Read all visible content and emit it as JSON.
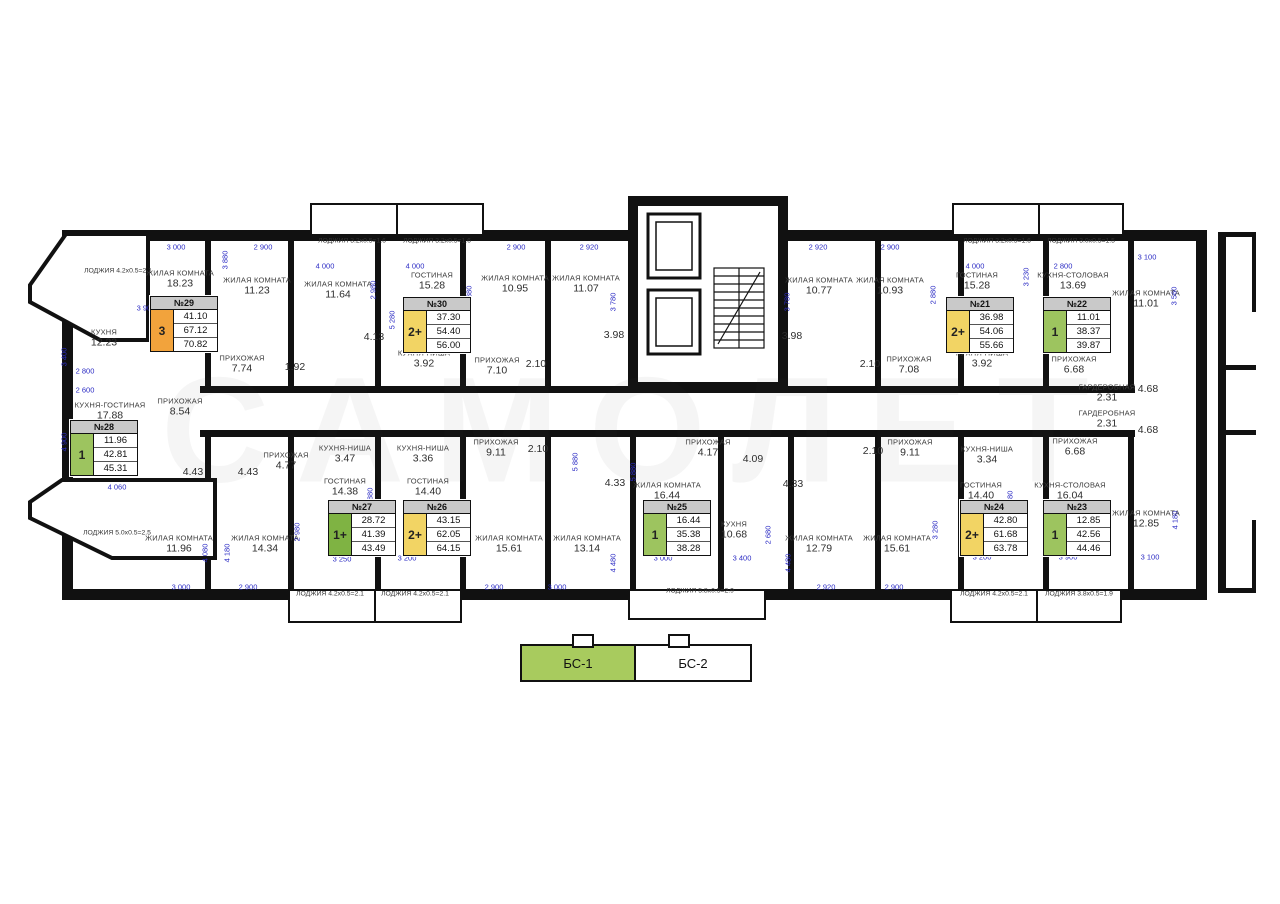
{
  "watermark": "САМОЛЕТ",
  "legend": {
    "bs1": "БС-1",
    "bs2": "БС-2"
  },
  "colors": {
    "wall": "#111111",
    "dim_blue": "#2b2bc4",
    "card_header_gray": "#c9c9c9",
    "badge_orange": "#f2a33c",
    "badge_yellow": "#f2d464",
    "badge_green": "#9dc45f",
    "badge_dark_green": "#7fb343",
    "legend_green": "#a8cb5e"
  },
  "cards": [
    {
      "num": "№29",
      "badge": "3",
      "bc": "badge_orange",
      "v1": "41.10",
      "v2": "67.12",
      "v3": "70.82",
      "x": 150,
      "y": 296
    },
    {
      "num": "№30",
      "badge": "2+",
      "bc": "badge_yellow",
      "v1": "37.30",
      "v2": "54.40",
      "v3": "56.00",
      "x": 403,
      "y": 297
    },
    {
      "num": "№21",
      "badge": "2+",
      "bc": "badge_yellow",
      "v1": "36.98",
      "v2": "54.06",
      "v3": "55.66",
      "x": 946,
      "y": 297
    },
    {
      "num": "№22",
      "badge": "1",
      "bc": "badge_green",
      "v1": "11.01",
      "v2": "38.37",
      "v3": "39.87",
      "x": 1043,
      "y": 297
    },
    {
      "num": "№28",
      "badge": "1",
      "bc": "badge_green",
      "v1": "11.96",
      "v2": "42.81",
      "v3": "45.31",
      "x": 70,
      "y": 420
    },
    {
      "num": "№27",
      "badge": "1+",
      "bc": "badge_dark_green",
      "v1": "28.72",
      "v2": "41.39",
      "v3": "43.49",
      "x": 328,
      "y": 500
    },
    {
      "num": "№26",
      "badge": "2+",
      "bc": "badge_yellow",
      "v1": "43.15",
      "v2": "62.05",
      "v3": "64.15",
      "x": 403,
      "y": 500
    },
    {
      "num": "№25",
      "badge": "1",
      "bc": "badge_green",
      "v1": "16.44",
      "v2": "35.38",
      "v3": "38.28",
      "x": 643,
      "y": 500
    },
    {
      "num": "№24",
      "badge": "2+",
      "bc": "badge_yellow",
      "v1": "42.80",
      "v2": "61.68",
      "v3": "63.78",
      "x": 960,
      "y": 500
    },
    {
      "num": "№23",
      "badge": "1",
      "bc": "badge_green",
      "v1": "12.85",
      "v2": "42.56",
      "v3": "44.46",
      "x": 1043,
      "y": 500
    }
  ],
  "rooms": [
    {
      "n": "ЛОДЖИЯ 4.2x0.5=2.1",
      "a": "",
      "x": 118,
      "y": 271,
      "s": 1
    },
    {
      "n": "ЖИЛАЯ КОМНАТА",
      "a": "18.23",
      "x": 180,
      "y": 279
    },
    {
      "n": "КУХНЯ",
      "a": "12.23",
      "x": 104,
      "y": 338
    },
    {
      "n": "ЖИЛАЯ КОМНАТА",
      "a": "11.23",
      "x": 257,
      "y": 286
    },
    {
      "n": "ЖИЛАЯ КОМНАТА",
      "a": "11.64",
      "x": 338,
      "y": 290
    },
    {
      "n": "ГОСТИНАЯ",
      "a": "15.28",
      "x": 432,
      "y": 281
    },
    {
      "n": "ЖИЛАЯ КОМНАТА",
      "a": "10.95",
      "x": 515,
      "y": 284
    },
    {
      "n": "ЖИЛАЯ КОМНАТА",
      "a": "11.07",
      "x": 586,
      "y": 284
    },
    {
      "n": "ЖИЛАЯ КОМНАТА",
      "a": "10.77",
      "x": 819,
      "y": 286
    },
    {
      "n": "ЖИЛАЯ КОМНАТА",
      "a": "10.93",
      "x": 890,
      "y": 286
    },
    {
      "n": "ГОСТИНАЯ",
      "a": "15.28",
      "x": 977,
      "y": 281
    },
    {
      "n": "КУХНЯ-СТОЛОВАЯ",
      "a": "13.69",
      "x": 1073,
      "y": 281
    },
    {
      "n": "ЖИЛАЯ КОМНАТА",
      "a": "11.01",
      "x": 1146,
      "y": 299
    },
    {
      "n": "ПРИХОЖАЯ",
      "a": "7.74",
      "x": 242,
      "y": 364
    },
    {
      "n": "",
      "a": "1.92",
      "x": 295,
      "y": 367
    },
    {
      "n": "",
      "a": "4.13",
      "x": 374,
      "y": 337
    },
    {
      "n": "КУХНЯ-НИША",
      "a": "3.92",
      "x": 424,
      "y": 359
    },
    {
      "n": "ПРИХОЖАЯ",
      "a": "7.10",
      "x": 497,
      "y": 366
    },
    {
      "n": "",
      "a": "2.10",
      "x": 536,
      "y": 364
    },
    {
      "n": "",
      "a": "3.98",
      "x": 614,
      "y": 335
    },
    {
      "n": "",
      "a": "3.98",
      "x": 792,
      "y": 336
    },
    {
      "n": "",
      "a": "2.10",
      "x": 870,
      "y": 364
    },
    {
      "n": "ПРИХОЖАЯ",
      "a": "7.08",
      "x": 909,
      "y": 365
    },
    {
      "n": "КУХНЯ-НИША",
      "a": "3.92",
      "x": 982,
      "y": 359
    },
    {
      "n": "ПРИХОЖАЯ",
      "a": "6.68",
      "x": 1074,
      "y": 365
    },
    {
      "n": "ГАРДЕРОБНАЯ",
      "a": "2.31",
      "x": 1107,
      "y": 393
    },
    {
      "n": "ГАРДЕРОБНАЯ",
      "a": "2.31",
      "x": 1107,
      "y": 419
    },
    {
      "n": "",
      "a": "4.68",
      "x": 1148,
      "y": 389
    },
    {
      "n": "",
      "a": "4.68",
      "x": 1148,
      "y": 430
    },
    {
      "n": "КУХНЯ-ГОСТИНАЯ",
      "a": "17.88",
      "x": 110,
      "y": 411
    },
    {
      "n": "ПРИХОЖАЯ",
      "a": "8.54",
      "x": 180,
      "y": 407
    },
    {
      "n": "",
      "a": "4.43",
      "x": 193,
      "y": 472
    },
    {
      "n": "",
      "a": "4.43",
      "x": 248,
      "y": 472
    },
    {
      "n": "ПРИХОЖАЯ",
      "a": "4.77",
      "x": 286,
      "y": 461
    },
    {
      "n": "КУХНЯ-НИША",
      "a": "3.47",
      "x": 345,
      "y": 454
    },
    {
      "n": "ГОСТИНАЯ",
      "a": "14.38",
      "x": 345,
      "y": 487
    },
    {
      "n": "ЛОДЖИЯ 5.0x0.5=2.5",
      "a": "",
      "x": 117,
      "y": 533,
      "s": 1
    },
    {
      "n": "ЖИЛАЯ КОМНАТА",
      "a": "11.96",
      "x": 179,
      "y": 544
    },
    {
      "n": "ЖИЛАЯ КОМНАТА",
      "a": "14.34",
      "x": 265,
      "y": 544
    },
    {
      "n": "КУХНЯ-НИША",
      "a": "3.36",
      "x": 423,
      "y": 454
    },
    {
      "n": "ГОСТИНАЯ",
      "a": "14.40",
      "x": 428,
      "y": 487
    },
    {
      "n": "ПРИХОЖАЯ",
      "a": "9.11",
      "x": 496,
      "y": 448
    },
    {
      "n": "",
      "a": "2.10",
      "x": 538,
      "y": 449
    },
    {
      "n": "ЖИЛАЯ КОМНАТА",
      "a": "15.61",
      "x": 509,
      "y": 544
    },
    {
      "n": "ЖИЛАЯ КОМНАТА",
      "a": "13.14",
      "x": 587,
      "y": 544
    },
    {
      "n": "",
      "a": "4.33",
      "x": 615,
      "y": 483
    },
    {
      "n": "ПРИХОЖАЯ",
      "a": "4.17",
      "x": 708,
      "y": 448
    },
    {
      "n": "",
      "a": "4.09",
      "x": 753,
      "y": 459
    },
    {
      "n": "ЖИЛАЯ КОМНАТА",
      "a": "16.44",
      "x": 667,
      "y": 491
    },
    {
      "n": "КУХНЯ",
      "a": "10.68",
      "x": 734,
      "y": 530
    },
    {
      "n": "",
      "a": "4.33",
      "x": 793,
      "y": 484
    },
    {
      "n": "ЖИЛАЯ КОМНАТА",
      "a": "12.79",
      "x": 819,
      "y": 544
    },
    {
      "n": "ЖИЛАЯ КОМНАТА",
      "a": "15.61",
      "x": 897,
      "y": 544
    },
    {
      "n": "",
      "a": "2.10",
      "x": 873,
      "y": 451
    },
    {
      "n": "ПРИХОЖАЯ",
      "a": "9.11",
      "x": 910,
      "y": 448
    },
    {
      "n": "КУХНЯ-НИША",
      "a": "3.34",
      "x": 987,
      "y": 455
    },
    {
      "n": "ГОСТИНАЯ",
      "a": "14.40",
      "x": 981,
      "y": 491
    },
    {
      "n": "КУХНЯ-СТОЛОВАЯ",
      "a": "16.04",
      "x": 1070,
      "y": 491
    },
    {
      "n": "ЖИЛАЯ КОМНАТА",
      "a": "12.85",
      "x": 1146,
      "y": 519
    },
    {
      "n": "ПРИХОЖАЯ",
      "a": "6.68",
      "x": 1075,
      "y": 447
    },
    {
      "n": "ЛОДЖИЯ 3.2x0.5=1.6",
      "a": "",
      "x": 352,
      "y": 241,
      "s": 1
    },
    {
      "n": "ЛОДЖИЯ 3.2x0.5=1.6",
      "a": "",
      "x": 437,
      "y": 241,
      "s": 1
    },
    {
      "n": "ЛОДЖИЯ 3.2x0.5=1.6",
      "a": "",
      "x": 997,
      "y": 241,
      "s": 1
    },
    {
      "n": "ЛОДЖИЯ 3.0x0.5=1.5",
      "a": "",
      "x": 1081,
      "y": 241,
      "s": 1
    },
    {
      "n": "ЛОДЖИЯ 4.2x0.5=2.1",
      "a": "",
      "x": 330,
      "y": 594,
      "s": 1
    },
    {
      "n": "ЛОДЖИЯ 4.2x0.5=2.1",
      "a": "",
      "x": 415,
      "y": 594,
      "s": 1
    },
    {
      "n": "ЛОДЖИЯ 5.8x0.5=2.9",
      "a": "",
      "x": 700,
      "y": 591,
      "s": 1
    },
    {
      "n": "ЛОДЖИЯ 4.2x0.5=2.1",
      "a": "",
      "x": 994,
      "y": 594,
      "s": 1
    },
    {
      "n": "ЛОДЖИЯ 3.8x0.5=1.9",
      "a": "",
      "x": 1079,
      "y": 594,
      "s": 1
    }
  ],
  "dims": [
    {
      "t": "3 000",
      "x": 176,
      "y": 247
    },
    {
      "t": "2 900",
      "x": 263,
      "y": 247
    },
    {
      "t": "2 900",
      "x": 516,
      "y": 247
    },
    {
      "t": "2 920",
      "x": 589,
      "y": 247
    },
    {
      "t": "2 920",
      "x": 818,
      "y": 247
    },
    {
      "t": "2 900",
      "x": 890,
      "y": 247
    },
    {
      "t": "3 100",
      "x": 1147,
      "y": 257
    },
    {
      "t": "4 000",
      "x": 325,
      "y": 266
    },
    {
      "t": "4 000",
      "x": 415,
      "y": 266
    },
    {
      "t": "4 000",
      "x": 975,
      "y": 266
    },
    {
      "t": "2 800",
      "x": 1063,
      "y": 266
    },
    {
      "t": "3 900",
      "x": 146,
      "y": 308
    },
    {
      "t": "2 800",
      "x": 85,
      "y": 371
    },
    {
      "t": "2 600",
      "x": 85,
      "y": 390
    },
    {
      "t": "4 060",
      "x": 117,
      "y": 487
    },
    {
      "t": "3 250",
      "x": 342,
      "y": 559
    },
    {
      "t": "3 200",
      "x": 407,
      "y": 558
    },
    {
      "t": "3 000",
      "x": 663,
      "y": 558
    },
    {
      "t": "3 400",
      "x": 742,
      "y": 558
    },
    {
      "t": "3 200",
      "x": 982,
      "y": 557
    },
    {
      "t": "3 900",
      "x": 1068,
      "y": 557
    },
    {
      "t": "3 100",
      "x": 1150,
      "y": 557
    },
    {
      "t": "3 000",
      "x": 181,
      "y": 587
    },
    {
      "t": "2 900",
      "x": 248,
      "y": 587
    },
    {
      "t": "2 900",
      "x": 494,
      "y": 587
    },
    {
      "t": "3 000",
      "x": 557,
      "y": 587
    },
    {
      "t": "2 920",
      "x": 826,
      "y": 587
    },
    {
      "t": "2 900",
      "x": 894,
      "y": 587
    },
    {
      "t": "3 400",
      "x": 64,
      "y": 357,
      "v": 1
    },
    {
      "t": "4 900",
      "x": 64,
      "y": 442,
      "v": 1
    },
    {
      "t": "6 180",
      "x": 210,
      "y": 328,
      "v": 1
    },
    {
      "t": "3 880",
      "x": 225,
      "y": 260,
      "v": 1
    },
    {
      "t": "2 980",
      "x": 373,
      "y": 290,
      "v": 1
    },
    {
      "t": "5 280",
      "x": 392,
      "y": 320,
      "v": 1
    },
    {
      "t": "2 880",
      "x": 469,
      "y": 295,
      "v": 1
    },
    {
      "t": "3 780",
      "x": 613,
      "y": 302,
      "v": 1
    },
    {
      "t": "3 780",
      "x": 787,
      "y": 302,
      "v": 1
    },
    {
      "t": "2 880",
      "x": 933,
      "y": 295,
      "v": 1
    },
    {
      "t": "3 230",
      "x": 1026,
      "y": 277,
      "v": 1
    },
    {
      "t": "5 280",
      "x": 1010,
      "y": 318,
      "v": 1
    },
    {
      "t": "3 560",
      "x": 1174,
      "y": 296,
      "v": 1
    },
    {
      "t": "5 880",
      "x": 370,
      "y": 497,
      "v": 1
    },
    {
      "t": "5 880",
      "x": 575,
      "y": 462,
      "v": 1
    },
    {
      "t": "5 880",
      "x": 633,
      "y": 472,
      "v": 1
    },
    {
      "t": "5 880",
      "x": 1010,
      "y": 500,
      "v": 1
    },
    {
      "t": "2 980",
      "x": 297,
      "y": 532,
      "v": 1
    },
    {
      "t": "4 080",
      "x": 205,
      "y": 553,
      "v": 1
    },
    {
      "t": "4 180",
      "x": 227,
      "y": 553,
      "v": 1
    },
    {
      "t": "3 260",
      "x": 467,
      "y": 536,
      "v": 1
    },
    {
      "t": "4 480",
      "x": 613,
      "y": 563,
      "v": 1
    },
    {
      "t": "4 480",
      "x": 788,
      "y": 563,
      "v": 1
    },
    {
      "t": "2 680",
      "x": 768,
      "y": 535,
      "v": 1
    },
    {
      "t": "3 280",
      "x": 935,
      "y": 530,
      "v": 1
    },
    {
      "t": "4 380",
      "x": 1101,
      "y": 514,
      "v": 1
    },
    {
      "t": "4 180",
      "x": 1175,
      "y": 520,
      "v": 1
    }
  ]
}
